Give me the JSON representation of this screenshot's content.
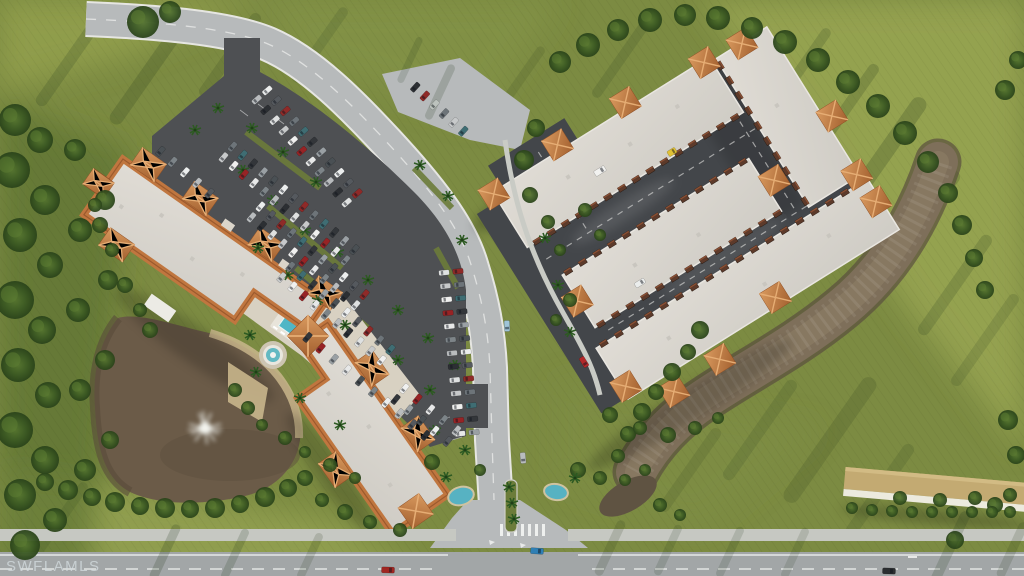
{
  "watermark": {
    "text": "SWFLAMLS"
  },
  "palette": {
    "grass": "#7c8b42",
    "grass-light": "#97a452",
    "grass-dark": "#5b7030",
    "tree-dark": "#2a431a",
    "tree-mid": "#3c5a23",
    "tree-light": "#55742f",
    "asphalt-lot": "#4e5053",
    "asphalt-drive": "#43464a",
    "road": "#b7babb",
    "road-bottom": "#a2a6a7",
    "sidewalk": "#c6c8c2",
    "roof-light": "#dcd8d1",
    "roof-right": "#d3d0ca",
    "tile": "#c0763f",
    "tile-light": "#d99a5f",
    "tile-dark": "#9b5a2e",
    "pond": "#6b5b48",
    "creek": "#7e6f5a",
    "water-teal": "#57b2c2",
    "concrete": "#d8d1c2",
    "sand": "#c9b68c",
    "carport-tan": "#c3aa72",
    "marking-white": "#eef0ee",
    "door-brown": "#5d3a2a"
  },
  "scene": {
    "car_colors": [
      "#eceeee",
      "#b9bcbe",
      "#55595e",
      "#2c2f33",
      "#8f2a28",
      "#dfe1e1",
      "#6d7479",
      "#c7c9ca",
      "#3f6d73",
      "#f0f0ef",
      "#33363a",
      "#972325",
      "#9aa0a4",
      "#e7e8e8",
      "#4a5054",
      "#7d8488"
    ],
    "parking_rows": [
      {
        "x1": 262,
        "y1": 95,
        "x2": 352,
        "y2": 198,
        "n": 11,
        "double": true
      },
      {
        "x1": 228,
        "y1": 152,
        "x2": 350,
        "y2": 255,
        "n": 13,
        "double": true
      },
      {
        "x1": 256,
        "y1": 212,
        "x2": 360,
        "y2": 300,
        "n": 11,
        "double": true
      },
      {
        "x1": 286,
        "y1": 272,
        "x2": 386,
        "y2": 355,
        "n": 10,
        "double": true
      },
      {
        "x1": 312,
        "y1": 332,
        "x2": 430,
        "y2": 430,
        "n": 10,
        "double": false
      },
      {
        "x1": 451,
        "y1": 272,
        "x2": 467,
        "y2": 433,
        "n": 13,
        "double": true
      },
      {
        "x1": 165,
        "y1": 146,
        "x2": 214,
        "y2": 188,
        "n": 5,
        "double": false
      },
      {
        "x1": 420,
        "y1": 82,
        "x2": 468,
        "y2": 126,
        "n": 6,
        "double": false
      },
      {
        "x1": 400,
        "y1": 394,
        "x2": 452,
        "y2": 436,
        "n": 5,
        "double": true
      }
    ],
    "vehicles": [
      {
        "x": 672,
        "y": 152,
        "a": -32,
        "c": "#e0c135",
        "l": 9,
        "w": 6
      },
      {
        "x": 600,
        "y": 171,
        "a": -32,
        "c": "#f2f2f0",
        "l": 12,
        "w": 6
      },
      {
        "x": 640,
        "y": 283,
        "a": -32,
        "c": "#ebedec",
        "l": 11,
        "w": 5.5
      },
      {
        "x": 584,
        "y": 362,
        "a": 58,
        "c": "#b3282a",
        "l": 11,
        "w": 5.5
      },
      {
        "x": 507,
        "y": 326,
        "a": 88,
        "c": "#9fc4d8",
        "l": 11,
        "w": 5.5
      },
      {
        "x": 523,
        "y": 458,
        "a": 85,
        "c": "#b9bcbe",
        "l": 11,
        "w": 5.5
      },
      {
        "x": 537,
        "y": 551,
        "a": 4,
        "c": "#2f7fb5",
        "l": 13,
        "w": 6
      },
      {
        "x": 388,
        "y": 570,
        "a": 2,
        "c": "#a02622",
        "l": 13,
        "w": 6
      },
      {
        "x": 889,
        "y": 571,
        "a": 2,
        "c": "#2b2e30",
        "l": 13,
        "w": 6
      }
    ],
    "garage_door_faces": [
      {
        "x1": -148,
        "y1": -70,
        "x2": 85,
        "y2": -70,
        "n": 15,
        "rot": 0
      },
      {
        "x1": -138,
        "y1": -28,
        "x2": 68,
        "y2": -28,
        "n": 13,
        "rot": 0
      },
      {
        "x1": -138,
        "y1": 34,
        "x2": 70,
        "y2": 34,
        "n": 13,
        "rot": 0
      },
      {
        "x1": -146,
        "y1": 52,
        "x2": 156,
        "y2": 52,
        "n": 18,
        "rot": 0
      },
      {
        "x1": 100,
        "y1": -122,
        "x2": 100,
        "y2": 38,
        "n": 10,
        "rot": 90
      }
    ],
    "rc_towers": [
      [
        -160,
        -133
      ],
      [
        -80,
        -141
      ],
      [
        0,
        -141
      ],
      [
        88,
        -133
      ],
      [
        130,
        -129
      ],
      [
        168,
        -20
      ],
      [
        158,
        43
      ],
      [
        -146,
        2
      ],
      [
        85,
        4
      ],
      [
        -150,
        100
      ],
      [
        -112,
        130
      ],
      [
        -56,
        127
      ],
      [
        24,
        104
      ],
      [
        160,
        76
      ]
    ],
    "trees": [
      [
        15,
        120,
        16
      ],
      [
        40,
        140,
        13
      ],
      [
        12,
        170,
        18
      ],
      [
        45,
        200,
        15
      ],
      [
        20,
        235,
        17
      ],
      [
        50,
        265,
        13
      ],
      [
        15,
        300,
        19
      ],
      [
        42,
        330,
        14
      ],
      [
        18,
        365,
        17
      ],
      [
        48,
        395,
        13
      ],
      [
        15,
        430,
        18
      ],
      [
        45,
        460,
        14
      ],
      [
        20,
        495,
        16
      ],
      [
        55,
        520,
        12
      ],
      [
        25,
        545,
        15
      ],
      [
        75,
        150,
        11
      ],
      [
        80,
        230,
        12
      ],
      [
        78,
        310,
        12
      ],
      [
        80,
        390,
        11
      ],
      [
        85,
        470,
        11
      ],
      [
        105,
        200,
        10
      ],
      [
        108,
        280,
        10
      ],
      [
        105,
        360,
        10
      ],
      [
        110,
        440,
        9
      ],
      [
        143,
        22,
        16
      ],
      [
        170,
        12,
        11
      ],
      [
        100,
        225,
        8
      ],
      [
        112,
        250,
        7
      ],
      [
        125,
        285,
        8
      ],
      [
        140,
        310,
        7
      ],
      [
        150,
        330,
        8
      ],
      [
        95,
        205,
        7
      ],
      [
        45,
        482,
        9
      ],
      [
        68,
        490,
        10
      ],
      [
        92,
        497,
        9
      ],
      [
        115,
        502,
        10
      ],
      [
        140,
        506,
        9
      ],
      [
        165,
        508,
        10
      ],
      [
        190,
        509,
        9
      ],
      [
        215,
        508,
        10
      ],
      [
        240,
        504,
        9
      ],
      [
        265,
        497,
        10
      ],
      [
        288,
        488,
        9
      ],
      [
        305,
        478,
        8
      ],
      [
        322,
        500,
        7
      ],
      [
        345,
        512,
        8
      ],
      [
        370,
        522,
        7
      ],
      [
        400,
        530,
        7
      ],
      [
        235,
        390,
        7
      ],
      [
        248,
        408,
        7
      ],
      [
        262,
        425,
        6
      ],
      [
        285,
        438,
        7
      ],
      [
        305,
        452,
        6
      ],
      [
        330,
        465,
        7
      ],
      [
        355,
        478,
        6
      ],
      [
        432,
        462,
        8
      ],
      [
        480,
        470,
        6
      ],
      [
        578,
        470,
        8
      ],
      [
        600,
        478,
        7
      ],
      [
        625,
        480,
        6
      ],
      [
        700,
        330,
        9
      ],
      [
        688,
        352,
        8
      ],
      [
        672,
        372,
        9
      ],
      [
        656,
        392,
        8
      ],
      [
        642,
        412,
        9
      ],
      [
        628,
        434,
        8
      ],
      [
        618,
        456,
        7
      ],
      [
        645,
        470,
        6
      ],
      [
        610,
        415,
        8
      ],
      [
        640,
        428,
        7
      ],
      [
        668,
        435,
        8
      ],
      [
        695,
        428,
        7
      ],
      [
        718,
        418,
        6
      ],
      [
        536,
        128,
        9
      ],
      [
        524,
        160,
        10
      ],
      [
        530,
        195,
        8
      ],
      [
        548,
        222,
        7
      ],
      [
        560,
        250,
        6
      ],
      [
        570,
        300,
        7
      ],
      [
        556,
        320,
        6
      ],
      [
        585,
        210,
        7
      ],
      [
        600,
        235,
        6
      ],
      [
        560,
        62,
        11
      ],
      [
        588,
        45,
        12
      ],
      [
        618,
        30,
        11
      ],
      [
        650,
        20,
        12
      ],
      [
        685,
        15,
        11
      ],
      [
        718,
        18,
        12
      ],
      [
        752,
        28,
        11
      ],
      [
        785,
        42,
        12
      ],
      [
        818,
        60,
        12
      ],
      [
        848,
        82,
        12
      ],
      [
        878,
        106,
        12
      ],
      [
        905,
        133,
        12
      ],
      [
        928,
        162,
        11
      ],
      [
        948,
        193,
        10
      ],
      [
        962,
        225,
        10
      ],
      [
        974,
        258,
        9
      ],
      [
        985,
        290,
        9
      ],
      [
        1005,
        90,
        10
      ],
      [
        1018,
        60,
        9
      ],
      [
        1008,
        420,
        10
      ],
      [
        1016,
        455,
        9
      ],
      [
        995,
        505,
        8
      ],
      [
        955,
        540,
        9
      ],
      [
        900,
        498,
        7
      ],
      [
        940,
        500,
        7
      ],
      [
        975,
        498,
        7
      ],
      [
        1010,
        495,
        7
      ],
      [
        852,
        508,
        6
      ],
      [
        872,
        510,
        6
      ],
      [
        892,
        511,
        6
      ],
      [
        912,
        512,
        6
      ],
      [
        932,
        512,
        6
      ],
      [
        952,
        512,
        6
      ],
      [
        972,
        512,
        6
      ],
      [
        992,
        512,
        6
      ],
      [
        1010,
        512,
        6
      ],
      [
        660,
        505,
        7
      ],
      [
        680,
        515,
        6
      ]
    ],
    "palms": [
      [
        252,
        128
      ],
      [
        283,
        152
      ],
      [
        316,
        182
      ],
      [
        243,
        170
      ],
      [
        273,
        200
      ],
      [
        305,
        230
      ],
      [
        258,
        248
      ],
      [
        288,
        275
      ],
      [
        318,
        300
      ],
      [
        345,
        325
      ],
      [
        338,
        252
      ],
      [
        368,
        280
      ],
      [
        398,
        310
      ],
      [
        428,
        338
      ],
      [
        420,
        165
      ],
      [
        448,
        196
      ],
      [
        462,
        240
      ],
      [
        455,
        365
      ],
      [
        430,
        390
      ],
      [
        398,
        360
      ],
      [
        250,
        335
      ],
      [
        256,
        372
      ],
      [
        300,
        398
      ],
      [
        340,
        425
      ],
      [
        509,
        487
      ],
      [
        512,
        503
      ],
      [
        514,
        519
      ],
      [
        446,
        477
      ],
      [
        575,
        478
      ],
      [
        545,
        238
      ],
      [
        558,
        285
      ],
      [
        570,
        332
      ],
      [
        465,
        450
      ],
      [
        435,
        430
      ],
      [
        218,
        108
      ],
      [
        195,
        130
      ]
    ],
    "streaks_ground": [
      [
        880,
        160,
        150,
        16,
        125,
        0.22
      ],
      [
        920,
        225,
        130,
        13,
        125,
        0.2
      ],
      [
        955,
        285,
        120,
        12,
        125,
        0.18
      ],
      [
        985,
        340,
        110,
        11,
        125,
        0.15
      ],
      [
        845,
        110,
        110,
        11,
        125,
        0.2
      ],
      [
        800,
        70,
        100,
        10,
        125,
        0.18
      ],
      [
        150,
        70,
        130,
        14,
        125,
        0.2
      ],
      [
        230,
        55,
        100,
        11,
        125,
        0.16
      ],
      [
        70,
        60,
        110,
        12,
        125,
        0.18
      ],
      [
        320,
        45,
        90,
        10,
        125,
        0.14
      ],
      [
        830,
        440,
        150,
        16,
        125,
        0.16
      ],
      [
        880,
        490,
        110,
        12,
        125,
        0.14
      ],
      [
        620,
        60,
        90,
        10,
        125,
        0.15
      ],
      [
        520,
        80,
        80,
        9,
        125,
        0.13
      ],
      [
        690,
        470,
        100,
        11,
        125,
        0.13
      ],
      [
        60,
        520,
        90,
        10,
        125,
        0.12
      ],
      [
        760,
        430,
        120,
        12,
        125,
        0.14
      ]
    ],
    "streaks_road": [
      [
        165,
        552,
        60,
        9,
        115,
        0.2
      ],
      [
        235,
        554,
        55,
        8,
        115,
        0.18
      ],
      [
        310,
        556,
        50,
        8,
        115,
        0.16
      ],
      [
        610,
        548,
        60,
        9,
        115,
        0.16
      ],
      [
        668,
        550,
        55,
        8,
        115,
        0.15
      ],
      [
        730,
        552,
        55,
        8,
        115,
        0.15
      ],
      [
        795,
        553,
        55,
        8,
        115,
        0.14
      ],
      [
        950,
        548,
        80,
        10,
        115,
        0.18
      ],
      [
        1012,
        550,
        60,
        9,
        115,
        0.16
      ],
      [
        440,
        92,
        60,
        8,
        115,
        0.18
      ],
      [
        410,
        60,
        50,
        7,
        115,
        0.15
      ]
    ]
  }
}
